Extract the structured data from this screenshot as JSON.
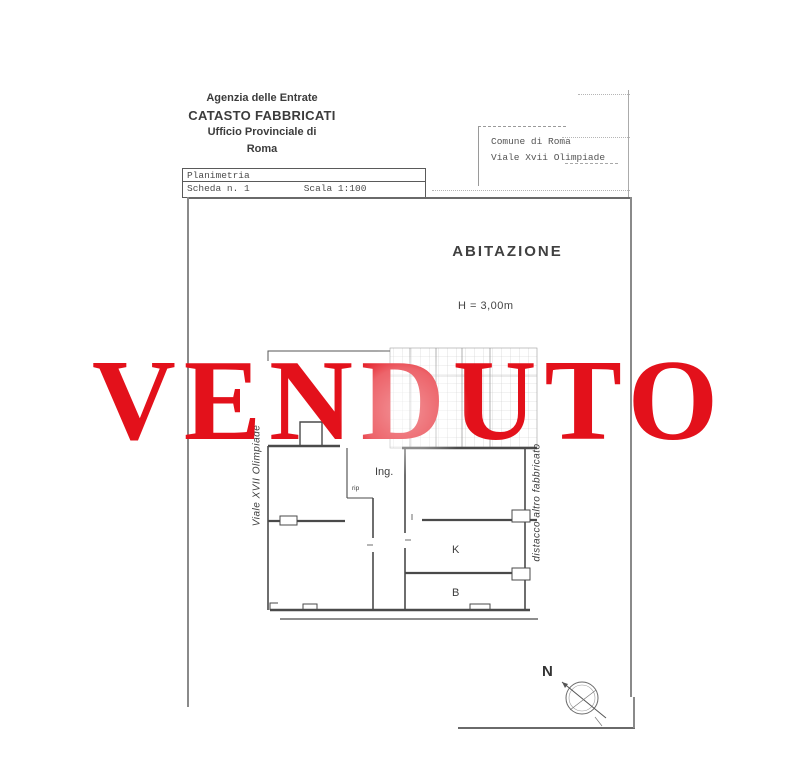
{
  "document": {
    "agency": {
      "line1": "Agenzia delle Entrate",
      "line2": "CATASTO FABBRICATI",
      "line3": "Ufficio Provinciale di",
      "line4": "Roma"
    },
    "location_box": {
      "line1": "Comune di Roma",
      "line2": "Viale Xvii Olimpiade"
    },
    "plan_header": {
      "title": "Planimetria",
      "sheet": "Scheda n. 1",
      "scale": "Scala 1:100"
    },
    "body": {
      "dwelling_label": "ABITAZIONE",
      "height_label": "H = 3,00m"
    },
    "floorplan": {
      "rooms": {
        "entrance": "Ing.",
        "closet": "rip",
        "kitchen": "K",
        "bathroom": "B"
      },
      "street_label": "Viale XVII Olimpiade",
      "detachment_label": "distacco altro fabbricato",
      "compass_north": "N"
    }
  },
  "watermark": {
    "text": "VENDUTO",
    "color": "#e3111b"
  }
}
